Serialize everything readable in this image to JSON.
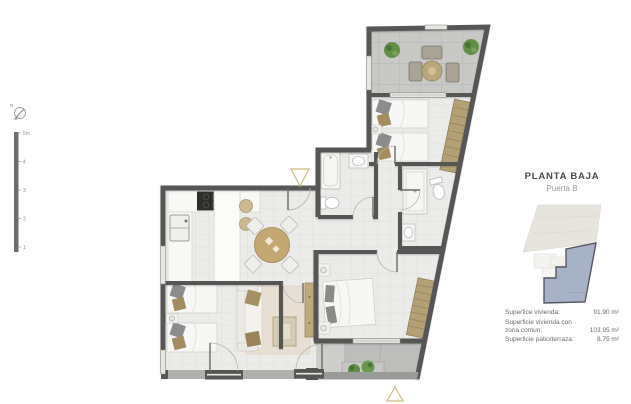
{
  "title_block": {
    "title": "PLANTA BAJA",
    "subtitle": "Puerta B"
  },
  "measurements": [
    {
      "label": "Superfice vivienda:",
      "value": "91.90 m²"
    },
    {
      "label": "Superficie vivienda con zona comun:",
      "value": "103.95 m²"
    },
    {
      "label": "Superficie patio/terraza:",
      "value": "8.75 m²"
    }
  ],
  "scale_bar": {
    "labels": [
      "5m",
      "4",
      "3",
      "2",
      "1"
    ]
  },
  "compass": {
    "label": "N"
  },
  "key_plan": {
    "building_fill": "#e7e4de",
    "unit_fill": "#a8b2c6",
    "unit_outline": "#565660"
  },
  "plan": {
    "colors": {
      "wall": "#565654",
      "floor_tile": "#ebebe9",
      "terrace_tile": "#c8c8c6",
      "patio_concrete": "#bdbdbb",
      "wardrobe": "#b3a077",
      "plant_green": "#5d8c46",
      "wood_table": "#c3a873",
      "marker_outline": "#d2bb80"
    },
    "icons": {
      "entrance_marker_top": "triangle-down-outline",
      "entrance_marker_bottom": "triangle-up-outline",
      "north_compass": "circle-with-needle"
    }
  }
}
